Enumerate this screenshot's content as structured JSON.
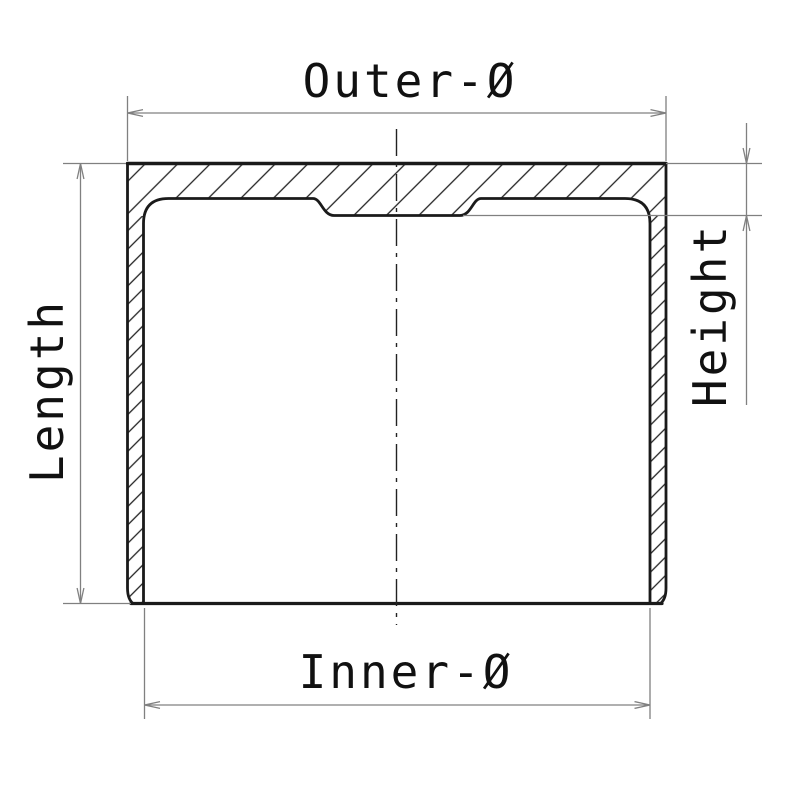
{
  "drawing": {
    "kind": "technical-cross-section",
    "background_color": "#ffffff",
    "outline_color": "#1a1a1a",
    "hatch_color": "#222222",
    "dimension_line_color": "#808080",
    "centerline_color": "#222222",
    "text_color": "#111111",
    "labels": {
      "outer_diameter": "Outer-Ø",
      "inner_diameter": "Inner-Ø",
      "length": "Length",
      "height": "Height"
    }
  }
}
